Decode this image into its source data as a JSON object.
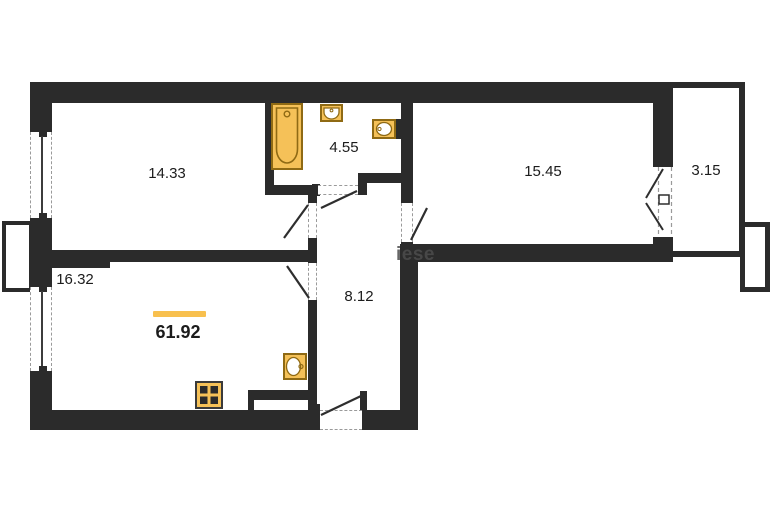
{
  "rooms": [
    {
      "key": "living",
      "area": "14.33"
    },
    {
      "key": "bathroom",
      "area": "4.55"
    },
    {
      "key": "bedroom",
      "area": "15.45"
    },
    {
      "key": "balcony",
      "area": "3.15"
    },
    {
      "key": "kitchen",
      "area": "16.32"
    },
    {
      "key": "hallway",
      "area": "8.12"
    }
  ],
  "total_area": "61.92",
  "watermark": "iese",
  "fixtures": [
    "bathtub",
    "sink",
    "sink",
    "sink",
    "stove"
  ],
  "colors": {
    "wall": "#2b2b2b",
    "accent": "#f8c04e",
    "fixture_fill": "#f5c158",
    "fixture_stroke": "#8f6a14",
    "watermark": "#4c4c4c"
  }
}
